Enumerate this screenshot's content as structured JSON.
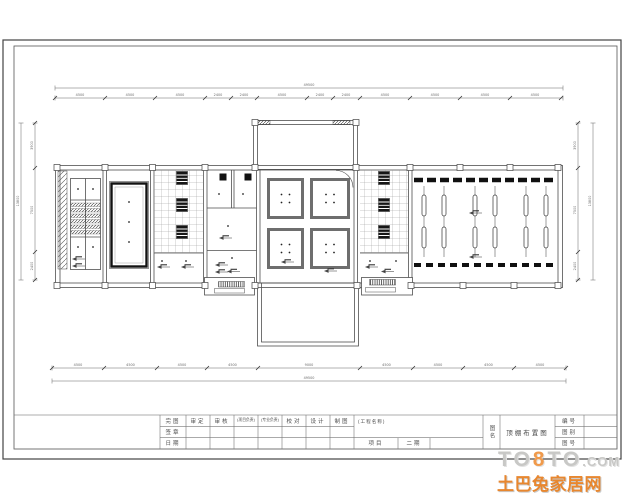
{
  "page": {
    "background": "#ffffff",
    "line_color": "#555555",
    "dark_fill_color": "#161616",
    "grid_color": "#8a8a8a"
  },
  "watermark": {
    "site_prefix": "TO",
    "site_eight": "8",
    "site_suffix": "TO",
    "site_domain": ".COM",
    "brand": "土巴兔家居网",
    "site_gray": "#c8c8c6",
    "eight_orange": "#f09a4b",
    "brand_orange": "#e8872f"
  },
  "title_block": {
    "sign_rows": [
      "完图",
      "签章",
      "日期"
    ],
    "headers": [
      "审定",
      "审核",
      "(项目负责)",
      "(专业负责)",
      "校对",
      "设计",
      "制图"
    ],
    "project_label": "(工程名称)",
    "item_label": "项目",
    "item_value": "二期",
    "name_label": "图名",
    "drawing_name": "顶棚布置图",
    "right_rows": [
      "编号",
      "图别",
      "图号"
    ]
  },
  "dims": {
    "top_segments": [
      "4500",
      "4500",
      "4500",
      "2400",
      "2400",
      "4500",
      "2400",
      "2400",
      "4500",
      "4500",
      "4500",
      "4500"
    ],
    "top_total": "49500",
    "bottom_segments": [
      "4500",
      "4500",
      "4500",
      "4500",
      "9000",
      "4500",
      "4500",
      "4500",
      "4500"
    ],
    "bottom_total": "49500",
    "left_segments": [
      "3900",
      "7500",
      "2400"
    ],
    "left_total": "13800",
    "right_segments": [
      "3900",
      "7500",
      "2400"
    ],
    "right_total": "13800"
  }
}
